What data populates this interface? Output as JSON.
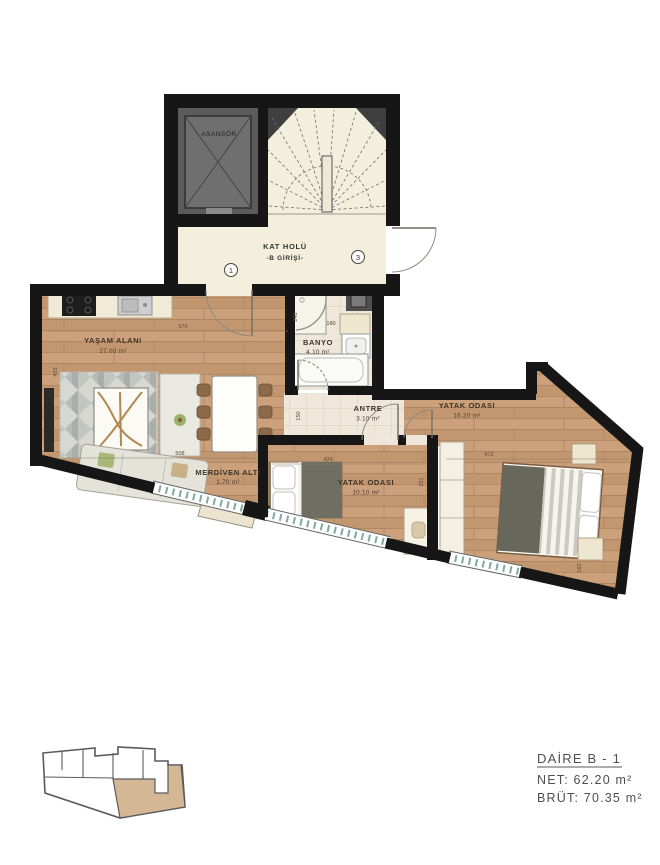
{
  "hall": {
    "elevator": "ASANSÖR",
    "label1": "KAT HOLÜ",
    "label2": "-B GİRİŞİ-",
    "door1": "1",
    "door3": "3"
  },
  "rooms": {
    "living": {
      "name": "YAŞAM ALANI",
      "area": "27.00 m²"
    },
    "bath": {
      "name": "BANYO",
      "area": "4.10 m²"
    },
    "entry": {
      "name": "ANTRE",
      "area": "3.10 m²"
    },
    "understairs": {
      "name": "MERDİVEN ALTI",
      "area": "1.70 m²"
    },
    "bedroom1": {
      "name": "YATAK ODASI",
      "area": "16.20 m²"
    },
    "bedroom2": {
      "name": "YATAK ODASI",
      "area": "10.10 m²"
    }
  },
  "dims": {
    "living_top": "570",
    "living_left": "453",
    "living_mid": "508",
    "bath_top": "180",
    "bath_left": "241",
    "entry_left": "150",
    "bedroom2_top": "424",
    "bedroom2_right": "291",
    "bedroom1_width": "472",
    "bedroom1_height": "162"
  },
  "legend": {
    "unit": "DAİRE B - 1",
    "net": "NET: 62.20 m²",
    "gross": "BRÜT: 70.35 m²"
  },
  "colors": {
    "wall": "#161616",
    "wood": "#c79d78",
    "tile": "#efe8da",
    "hall_floor": "#f4eedd",
    "keyplan_highlight": "#d4b896",
    "window_glass": "#7fa89e"
  }
}
